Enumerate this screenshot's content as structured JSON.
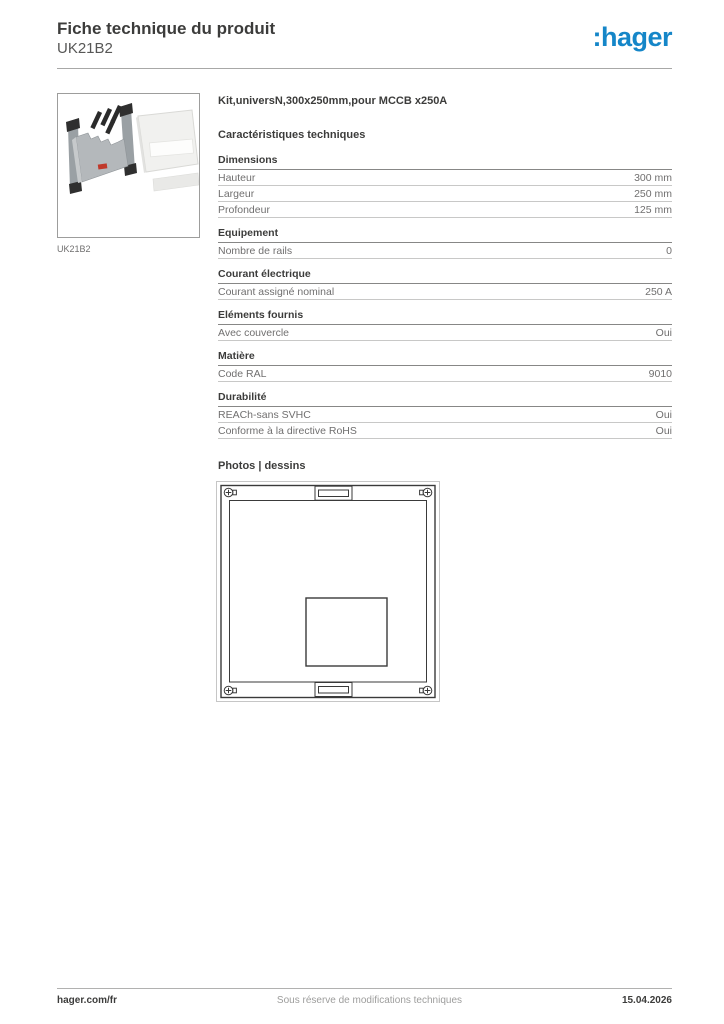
{
  "header": {
    "title": "Fiche technique du produit",
    "subtitle": "UK21B2",
    "logo_text": ":hager",
    "logo_color": "#1586c8"
  },
  "product": {
    "name": "Kit,universN,300x250mm,pour MCCB x250A",
    "image_caption": "UK21B2",
    "image_alt_icon": "product-photo-kit-with-cover"
  },
  "characteristics": {
    "heading": "Caractéristiques techniques",
    "sections": [
      {
        "title": "Dimensions",
        "rows": [
          {
            "label": "Hauteur",
            "value": "300 mm"
          },
          {
            "label": "Largeur",
            "value": "250 mm"
          },
          {
            "label": "Profondeur",
            "value": "125 mm"
          }
        ]
      },
      {
        "title": "Equipement",
        "rows": [
          {
            "label": "Nombre de rails",
            "value": "0"
          }
        ]
      },
      {
        "title": "Courant électrique",
        "rows": [
          {
            "label": "Courant assigné nominal",
            "value": "250 A"
          }
        ]
      },
      {
        "title": "Eléments fournis",
        "rows": [
          {
            "label": "Avec couvercle",
            "value": "Oui"
          }
        ]
      },
      {
        "title": "Matière",
        "rows": [
          {
            "label": "Code RAL",
            "value": "9010"
          }
        ]
      },
      {
        "title": "Durabilité",
        "rows": [
          {
            "label": "REACh-sans SVHC",
            "value": "Oui"
          },
          {
            "label": "Conforme à la directive RoHS",
            "value": "Oui"
          }
        ]
      }
    ]
  },
  "photos": {
    "heading": "Photos | dessins"
  },
  "footer": {
    "left": "hager.com/fr",
    "center": "Sous réserve de modifications techniques",
    "right": "15.04.2026"
  }
}
